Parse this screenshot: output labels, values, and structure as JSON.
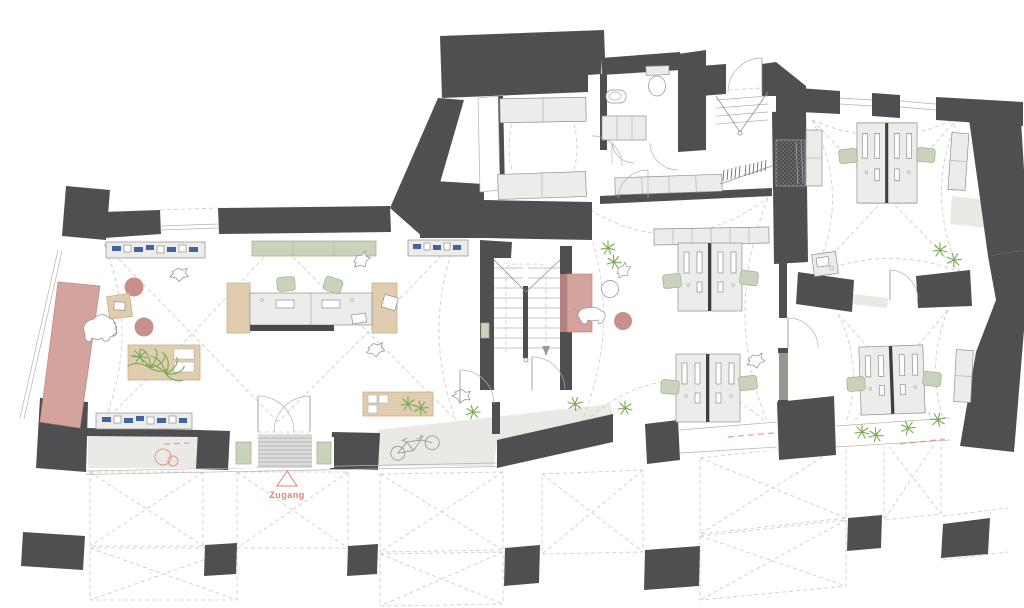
{
  "plan": {
    "access_label": "Zugang",
    "colors": {
      "wall": "#4f4f52",
      "annex_floor": "#e9e9e6",
      "furniture": "#ececea",
      "outline": "#8f8f8d",
      "dashed_line": "#c9c9c7",
      "pink": "#d4a39d",
      "pink_border": "#bb8a84",
      "pink_dark": "#c98f8b",
      "accent_red": "#e2836f",
      "sage_green": "#c9d3bb",
      "sage_border": "#9fae8e",
      "wood": "#e0cdb0",
      "wood_border": "#c2aa82",
      "shelf_blue": "#41659e",
      "plant_green": "#79a851"
    },
    "icons": {
      "entrance_marker": "triangle-outline",
      "figures": [
        "elephant-figure",
        "dog-figure",
        "bird-figure",
        "bicycle-icon",
        "plant-icon"
      ]
    }
  }
}
